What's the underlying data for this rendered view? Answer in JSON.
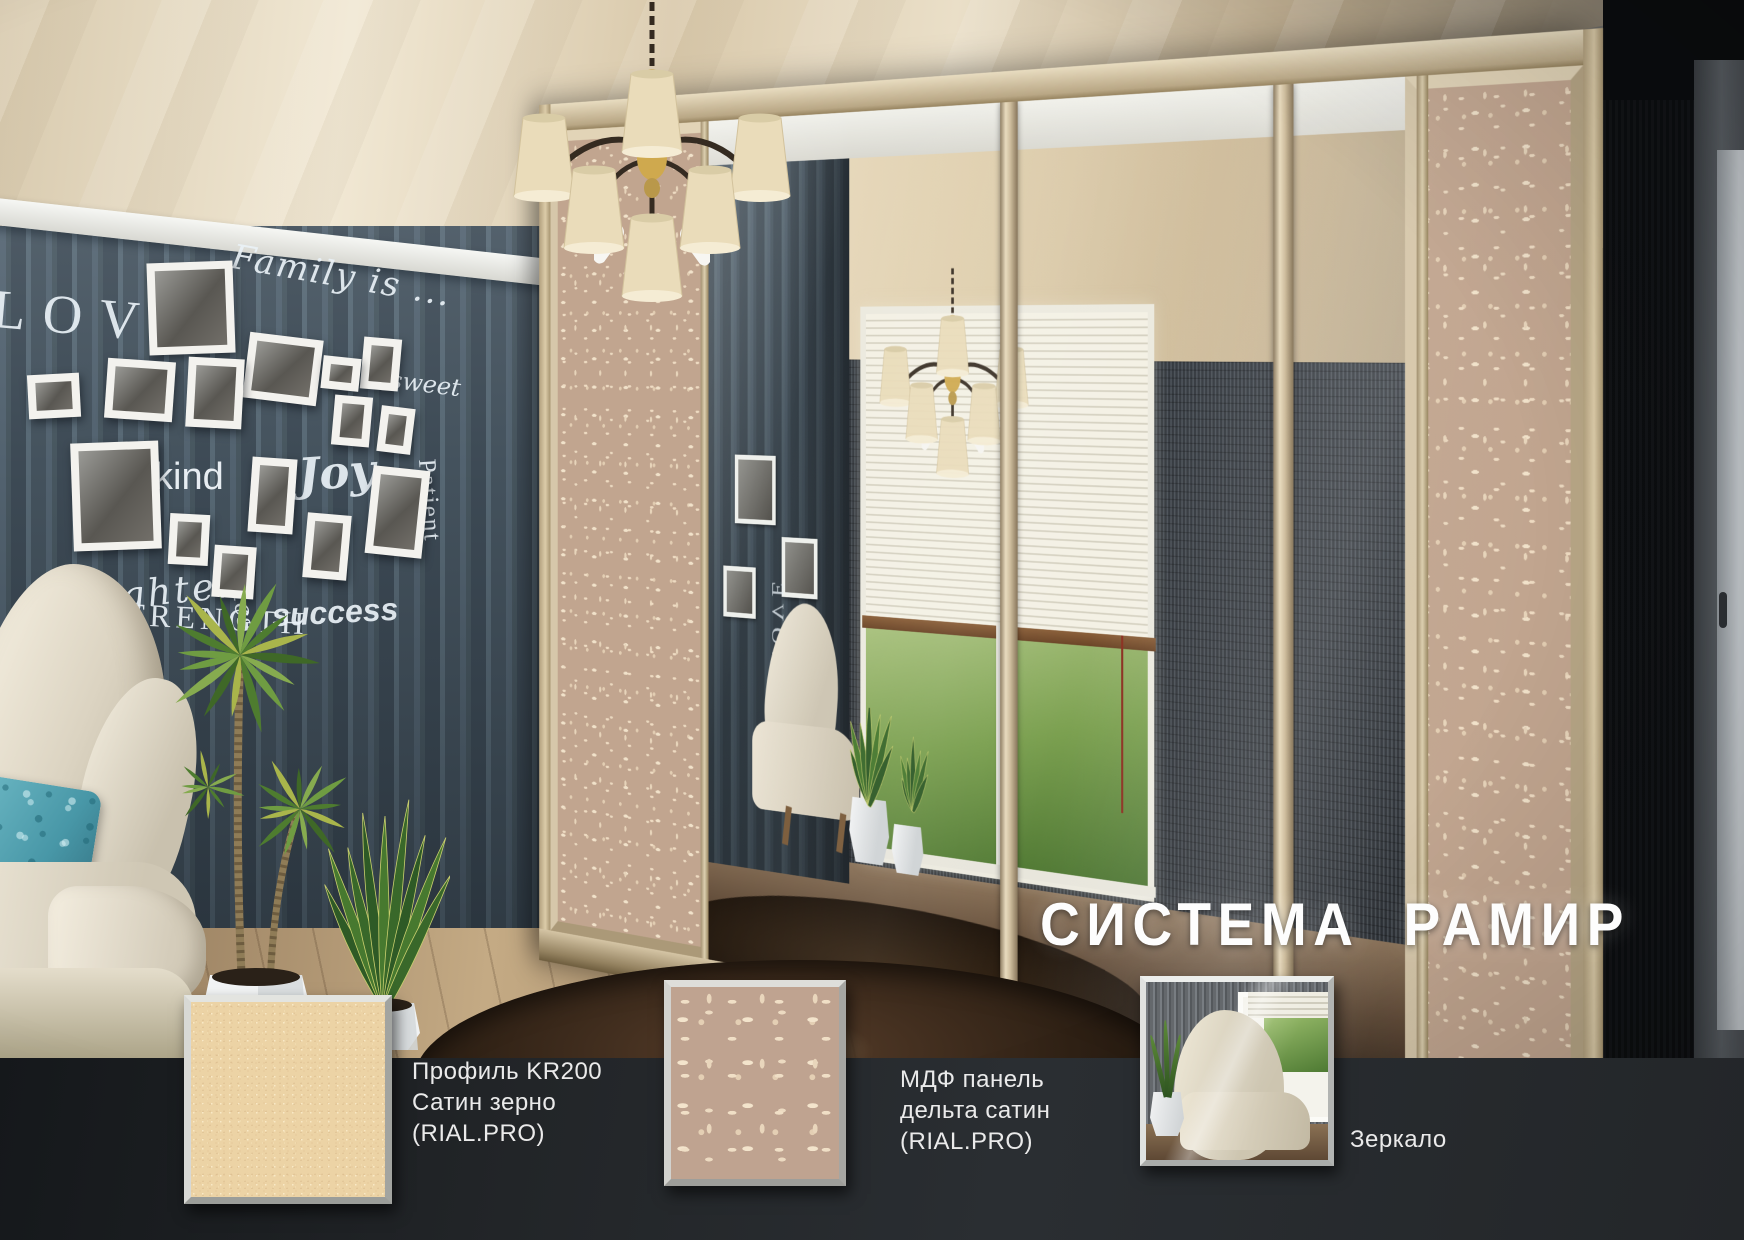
{
  "title": "СИСТЕМА РАМИР",
  "wall_art": {
    "words": [
      "LOVE",
      "Family is ...",
      "sweet",
      "special",
      "kind",
      "Joy",
      "Patient",
      "laughter",
      "smiles",
      "STRENGTH",
      "success"
    ]
  },
  "legend": {
    "items": [
      {
        "swatch": "satin-grain",
        "lines": [
          "Профиль KR200",
          "Сатин зерно",
          "(RIAL.PRO)"
        ]
      },
      {
        "swatch": "delta-satin",
        "lines": [
          "МДФ панель",
          "дельта сатин",
          "(RIAL.PRO)"
        ]
      },
      {
        "swatch": "mirror",
        "lines": [
          "Зеркало"
        ]
      }
    ]
  },
  "colors": {
    "ceiling_cream": "#e9dcc2",
    "wall_stripe_blue": "#46535f",
    "wardrobe_profile_beige": "#d6c7aa",
    "mdf_delta_satin": "#c1a58f",
    "satin_grain": "#ecd3a5",
    "legend_band": "#222528",
    "label_text": "#eaeaea",
    "title_text": "#fdfdfd",
    "rug_brown": "#2f2115",
    "pillow_teal": "#4897a7"
  }
}
